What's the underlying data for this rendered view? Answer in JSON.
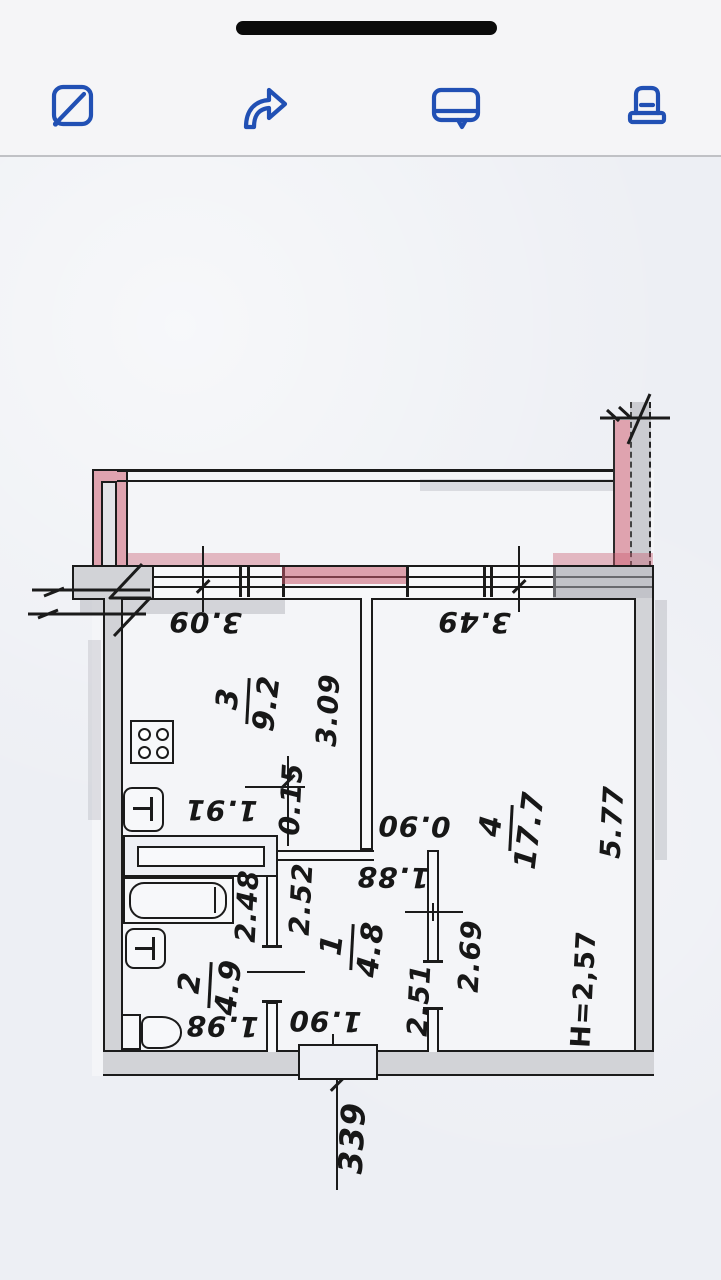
{
  "toolbar": {
    "icons": [
      {
        "name": "markup-icon"
      },
      {
        "name": "forward-icon"
      },
      {
        "name": "comment-icon"
      },
      {
        "name": "stamp-icon"
      }
    ],
    "accent_color": "#2150b4"
  },
  "plan": {
    "windows": {
      "left": "3.09",
      "right": "3.49"
    },
    "entry_number": "339",
    "ceiling_height": "H=2,57",
    "rooms": [
      {
        "id": "1",
        "area": "4.8",
        "dims": [
          "2.52",
          "1.90",
          "2.51",
          "1.88",
          "0.90"
        ]
      },
      {
        "id": "2",
        "area": "4.9",
        "dims": [
          "2.48",
          "1.98"
        ]
      },
      {
        "id": "3",
        "area": "9.2",
        "dims": [
          "3.09",
          "0.15",
          "1.91"
        ]
      },
      {
        "id": "4",
        "area": "17.7",
        "dims": [
          "5.77",
          "2.69"
        ]
      }
    ],
    "ink_color": "#1b1b1b",
    "highlight_pink": "#d2798c",
    "pencil_gray": "#cdced4"
  }
}
